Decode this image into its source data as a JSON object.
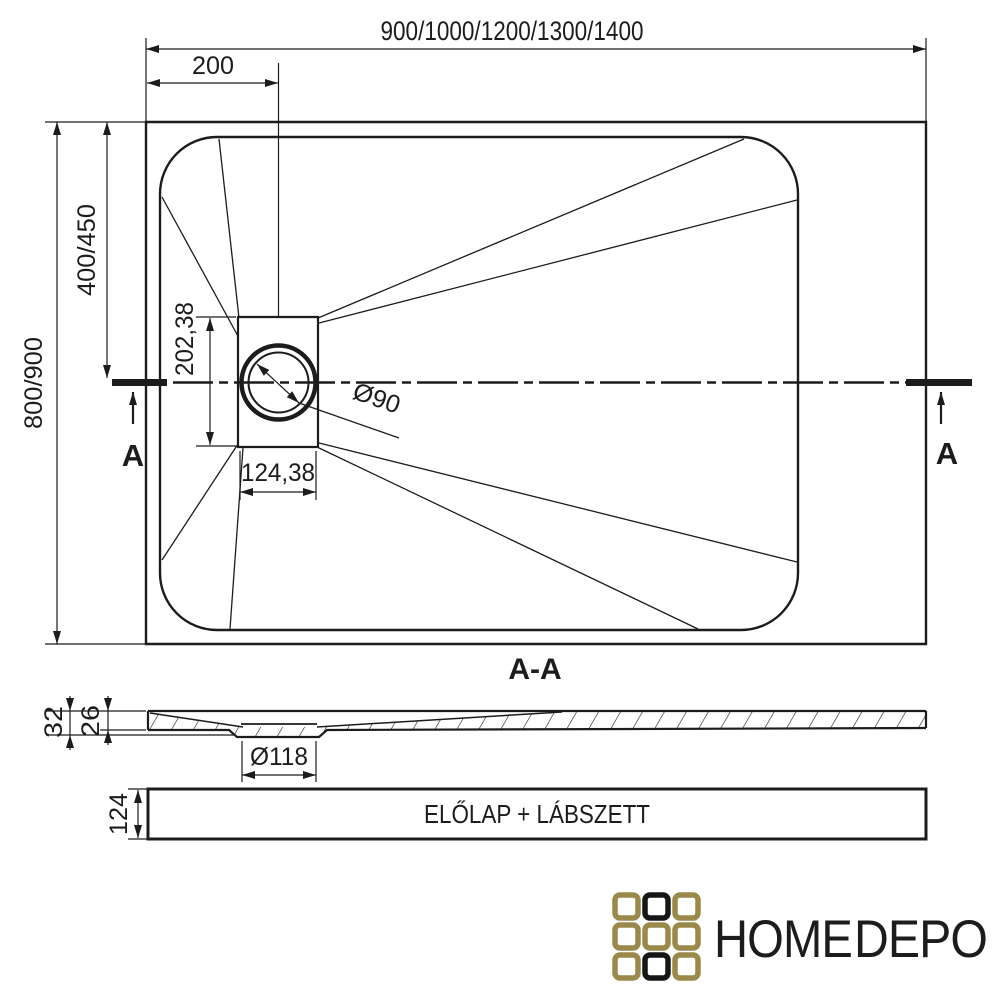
{
  "plan": {
    "width_options": "900/1000/1200/1300/1400",
    "drain_offset_x": "200",
    "drain_offset_y": "400/450",
    "depth_options": "800/900",
    "drain_box_height": "202,38",
    "drain_box_width": "124,38",
    "drain_diameter": "Ø90",
    "section_marker_left": "A",
    "section_marker_right": "A"
  },
  "section": {
    "title": "A-A",
    "total_height": "32",
    "tray_height": "26",
    "flange_diameter": "Ø118",
    "panel_label": "ELŐLAP + LÁBSZETT",
    "panel_height": "124"
  },
  "logo": {
    "word_home": "HOME",
    "word_depo": "DEPO",
    "gold": "#9a894b",
    "black": "#161616"
  }
}
